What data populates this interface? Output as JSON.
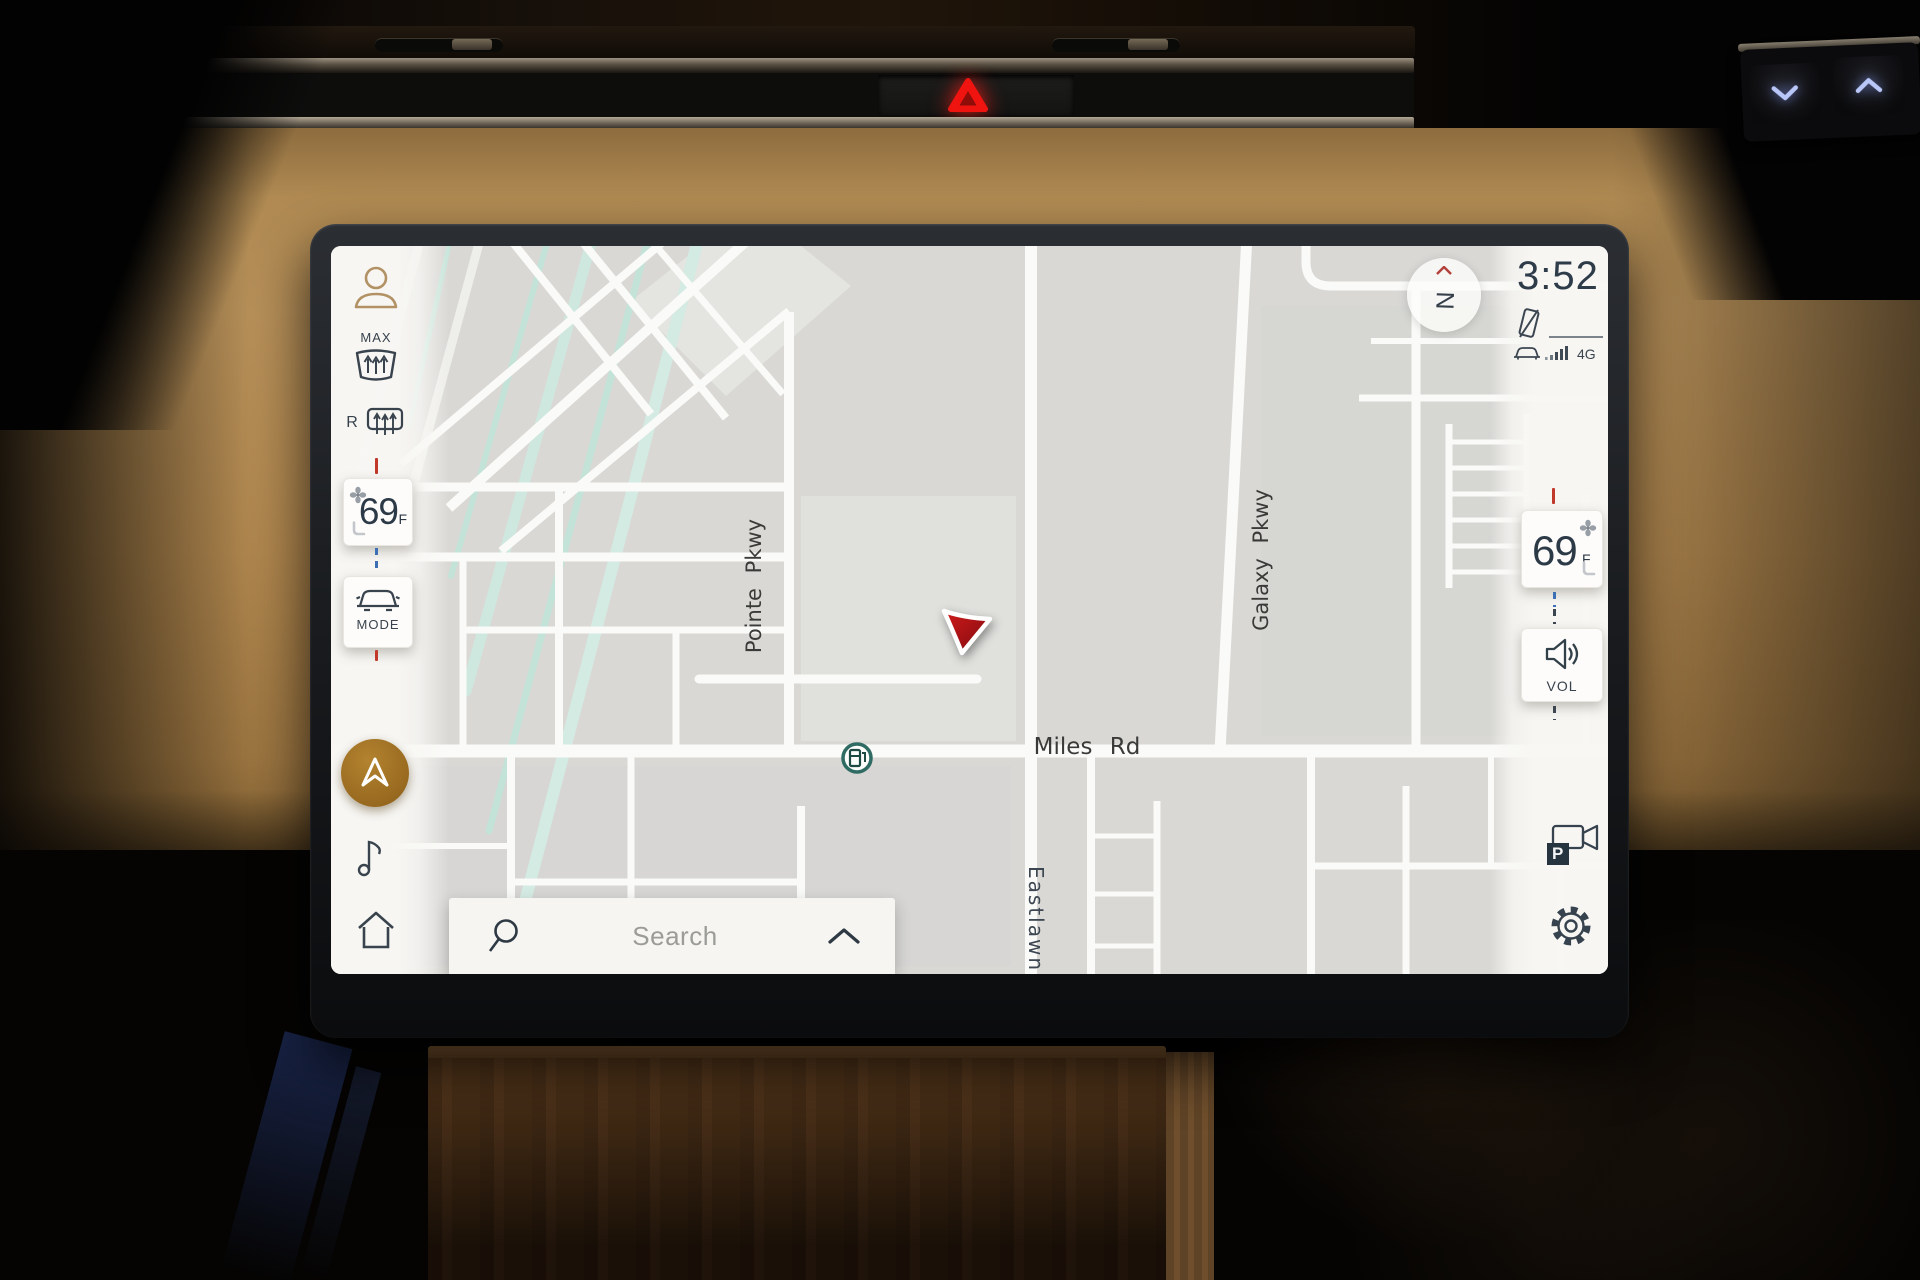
{
  "screen": {
    "clock": "3:52",
    "network_label": "4G",
    "compass_label": "N",
    "search_placeholder": "Search",
    "left_rail": {
      "max_defrost_label": "MAX",
      "rear_defrost_label": "R",
      "temp_value": "69",
      "temp_unit": "F",
      "mode_label": "MODE"
    },
    "right_rail": {
      "temp_value": "69",
      "temp_unit": "F",
      "volume_label": "VOL",
      "camera_parking_label": "P"
    },
    "map_labels": {
      "pointe": "Pointe Pkwy",
      "galaxy": "Galaxy Pkwy",
      "miles": "Miles Rd",
      "eastlawn": "Eastlawn"
    },
    "colors": {
      "accent_gold": "#9c6f24",
      "nav_arrow_red": "#b5121b",
      "tick_red": "#c0392b",
      "tick_blue": "#3d6fb4",
      "text_dark": "#36424e",
      "map_bg": "#d9d8d5",
      "road_white": "#fafaf8",
      "teal_road": "#c9e5dc",
      "hazard_red": "#ef1410"
    }
  }
}
